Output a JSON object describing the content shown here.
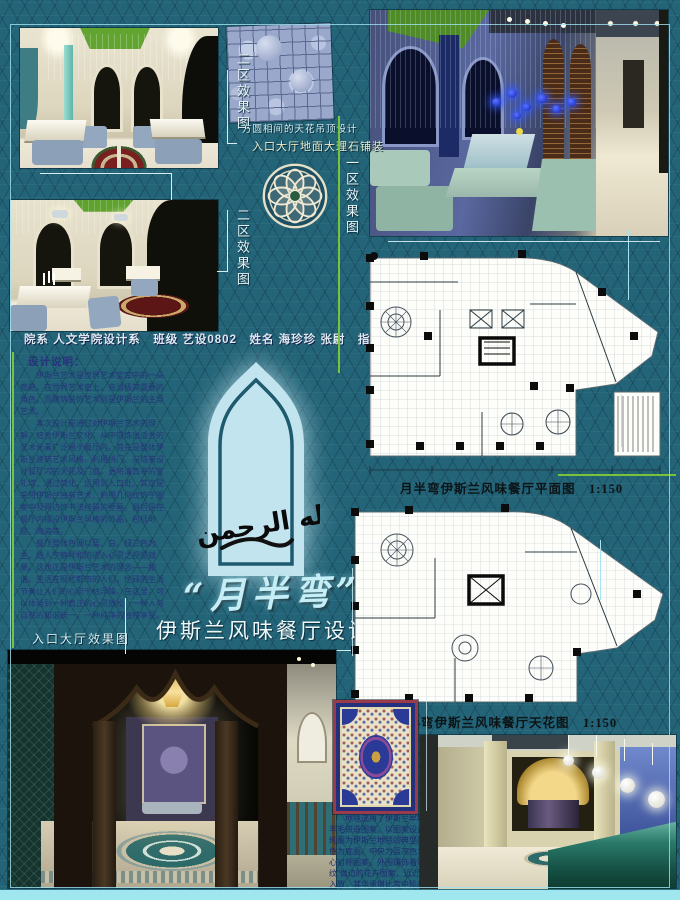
{
  "labels": {
    "zone2_top": "二区效果图",
    "zone2_mid": "二区效果图",
    "zone1": "一区效果图",
    "ceiling_note": "方圆相间的天花吊顶设计",
    "floor_note": "入口大厅地面大理石铺装",
    "entrance": "入口大厅效果图"
  },
  "title": {
    "main": "“月半弯”",
    "sub": "伊斯兰风味餐厅设计"
  },
  "info_line": "院系 人文学院设计系　班级 艺设0802　姓名 海珍珍 张尉　指导老师 陈超",
  "design_notes": {
    "title": "设计说明：",
    "p1": "伊斯兰艺术是世界艺术宝库中的一朵奇葩，在世界艺术史上，充当极其重要的角色，而建筑装饰艺术则是伊斯兰的主导艺术。",
    "p2": "本次设计是通过对伊斯兰艺术的理解，结合伊斯兰文化，从中提炼出适合的艺术元素广泛用于餐厅内。首先是整体伊斯兰建筑艺术风格，利用拱门、尖塔来设计餐厅内的天花及门窗，更将清真寺的宣礼塔，通过简化，运用到入口处。其次是采用伊斯兰独有艺术，利用几何纹饰于图案中及两边饰书法挂匾的壁画。最后是在餐厅内摆设伊斯兰风格的饰品，包括地毯、陶瓷等。",
    "p3": "餐厅整体色调以蓝、白、绿三色为主，给人宁静祥和的进入心灵之视觉效果。这也正是伊斯兰艺术的理念——和谐。生活在现代都市的人们，忙碌的生活节奏让人们的心灵干枯浮躁。在这里，可以体验到一种真正的心灵放松，一种人与自然的和谐统一，一种纯净的独特享受。"
  },
  "plans": {
    "floor_caption": "月半弯伊斯兰风味餐厅平面图　1:150",
    "ceiling_caption": "月半弯伊斯兰风味餐厅天花图　1:150"
  },
  "carpet": {
    "note": "地毯选用了伊斯兰早期波斯地毯的羊毛织造图案，以图案设计多变、色彩绚丽为伊斯兰地毯的典型风格——以白色为底面，中央为蓝灰色为主色调的中心对称图案，外围镶饰着以“阿拉伯纹”做边的花卉图案，远近有别、错落入致，其华贵堪比宫中珍品，体现了一种典雅高贵的视觉感受。"
  },
  "arch": {
    "calligraphy": "بسم الله الرحمن الرحيم"
  },
  "colors": {
    "background": "#236478",
    "accent_cyan": "#9fe6ef",
    "line_green": "#79c338",
    "title_cyan": "#c6eef6"
  }
}
